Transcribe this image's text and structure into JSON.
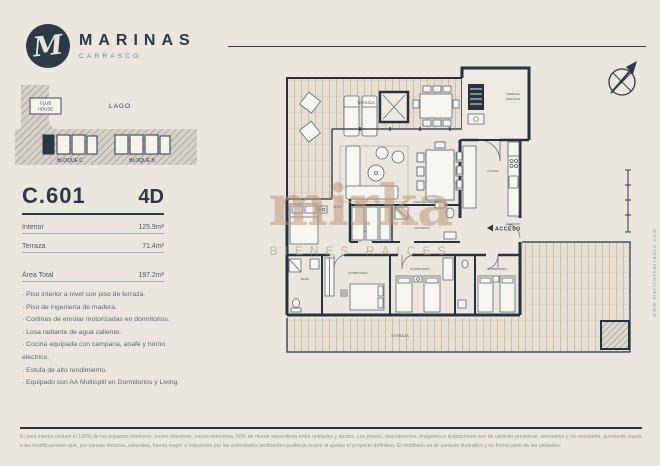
{
  "brand": {
    "name": "MARINAS",
    "sub": "CARRASCO",
    "monogram": "M"
  },
  "sitemap": {
    "lake": "LAGO",
    "clubhouse_line1": "CLUB",
    "clubhouse_line2": "HOUSE",
    "block_c": "BLOQUE C",
    "block_b": "BLOQUE B"
  },
  "unit": {
    "code": "C.601",
    "type": "4D",
    "rows": [
      {
        "label": "Interior",
        "value": "125.9m²"
      },
      {
        "label": "Terraza",
        "value": "71.4m²"
      }
    ],
    "total_label": "Área Total",
    "total_value": "197.2m²"
  },
  "features": [
    "Piso interior a nivel con piso de terraza.",
    "Piso de ingeniería de madera.",
    "Cortinas de enrolar motorizadas en dormitorios.",
    "Losa radiante de agua caliente.",
    "Cocina equipada con campana, anafe y horno eléctrico.",
    "Estufa de alto rendimiento.",
    "Equipado con AA Multisplit en Dormitorios y Living."
  ],
  "plan": {
    "terraza_top": "TERRAZA",
    "servicio_line1": "TERRAZA",
    "servicio_line2": "SERVICIO",
    "suite": "SUITE",
    "living_comedor": "LIVING COMEDOR",
    "vestidor": "VESTIDOR",
    "cocina": "COCINA",
    "acceso": "ACCESO",
    "bano": "BAÑO",
    "dormitorio_1": "DORMITORIO",
    "dormitorio_2": "DORMITORIO",
    "dormitorio_3": "DORMITORIO",
    "terraza_bottom": "TERRAZA",
    "website": "www.marinascarrasco.com"
  },
  "watermark": {
    "line1": "mirka",
    "line2": "BIENES RAICES"
  },
  "disclaimer": "El área interior incluye el 100% de los espacios interiores, muros interiores, muros exteriores, 50% de muros separativos entre unidades y ductos. Los planos, descripciones, imágenes e ilustraciones son de carácter preliminar, orientativo y no vinculante, quedando sujeta a las modificaciones que, por causas técnicas, naturales, fuerza mayor o impuestas por las autoridades pertinentes pudieran ocurrir al ajustar el proyecto definitivo. El mobiliario es de carácter ilustrativo y no forma parte de las unidades.",
  "colors": {
    "background": "#ece7de",
    "ink": "#2b3845",
    "wall": "#26323d",
    "deck_line": "#c2b29b",
    "watermark": "#bc9678",
    "muted": "#8e9297"
  }
}
